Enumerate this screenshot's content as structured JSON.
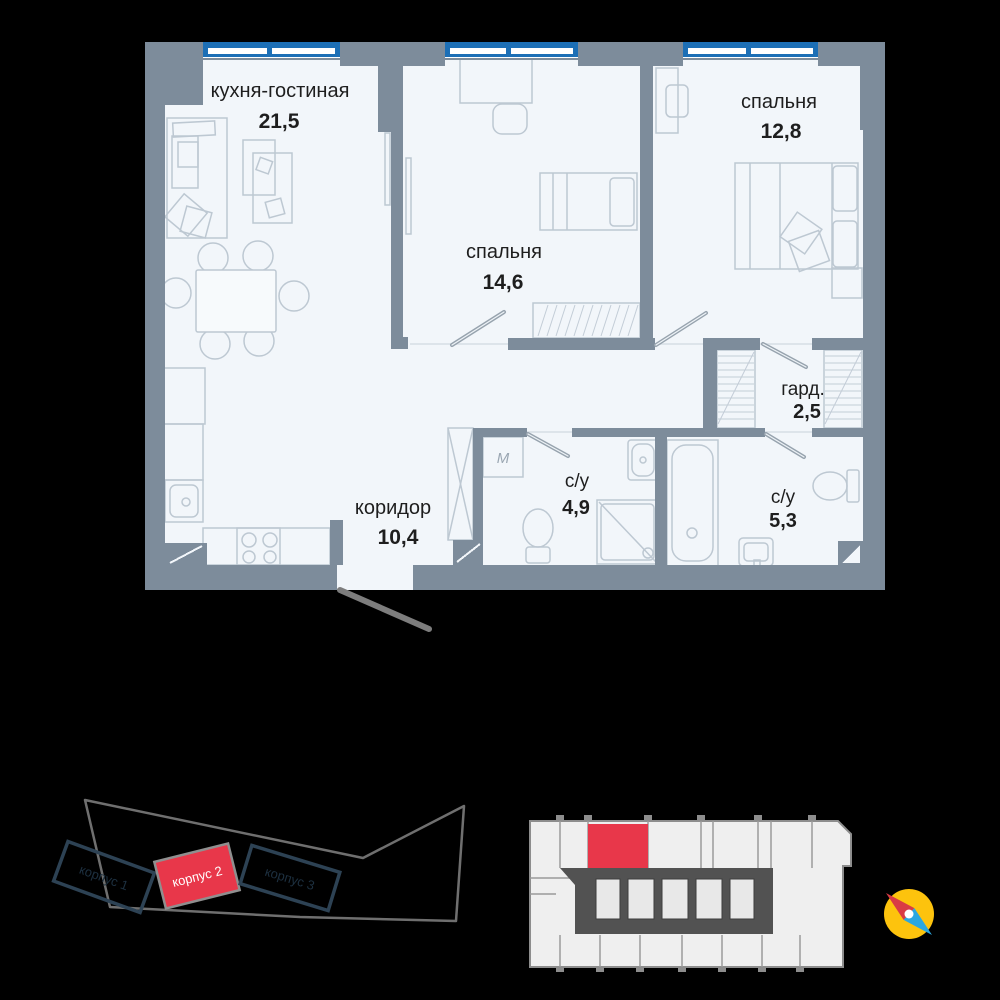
{
  "floor_plan": {
    "rooms": [
      {
        "name": "кухня-гостиная",
        "area": "21,5"
      },
      {
        "name": "спальня",
        "area": "14,6"
      },
      {
        "name": "спальня",
        "area": "12,8"
      },
      {
        "name": "гард.",
        "area": "2,5"
      },
      {
        "name": "с/у",
        "area": "4,9"
      },
      {
        "name": "с/у",
        "area": "5,3"
      },
      {
        "name": "коридор",
        "area": "10,4"
      }
    ],
    "washer_symbol": "M"
  },
  "site_plan": {
    "buildings": [
      {
        "label": "корпус 1",
        "highlighted": false
      },
      {
        "label": "корпус 2",
        "highlighted": true
      },
      {
        "label": "корпус 3",
        "highlighted": false
      }
    ]
  },
  "colors": {
    "background": "#000000",
    "wall": "#7d8c9b",
    "room_fill": "#f2f6fa",
    "window_blue": "#1c6fb6",
    "furniture_stroke": "#bdc8d2",
    "text": "#1e1e1e",
    "highlight_red": "#e8374a",
    "building_outline": "#2d4254",
    "site_outline": "#6f6f6f",
    "plate_fill": "#efefef",
    "plate_wall": "#8d8d8d",
    "plate_core": "#525252",
    "compass_yellow": "#fdc30d",
    "compass_red": "#d93b45",
    "compass_blue": "#2ba7e0"
  }
}
